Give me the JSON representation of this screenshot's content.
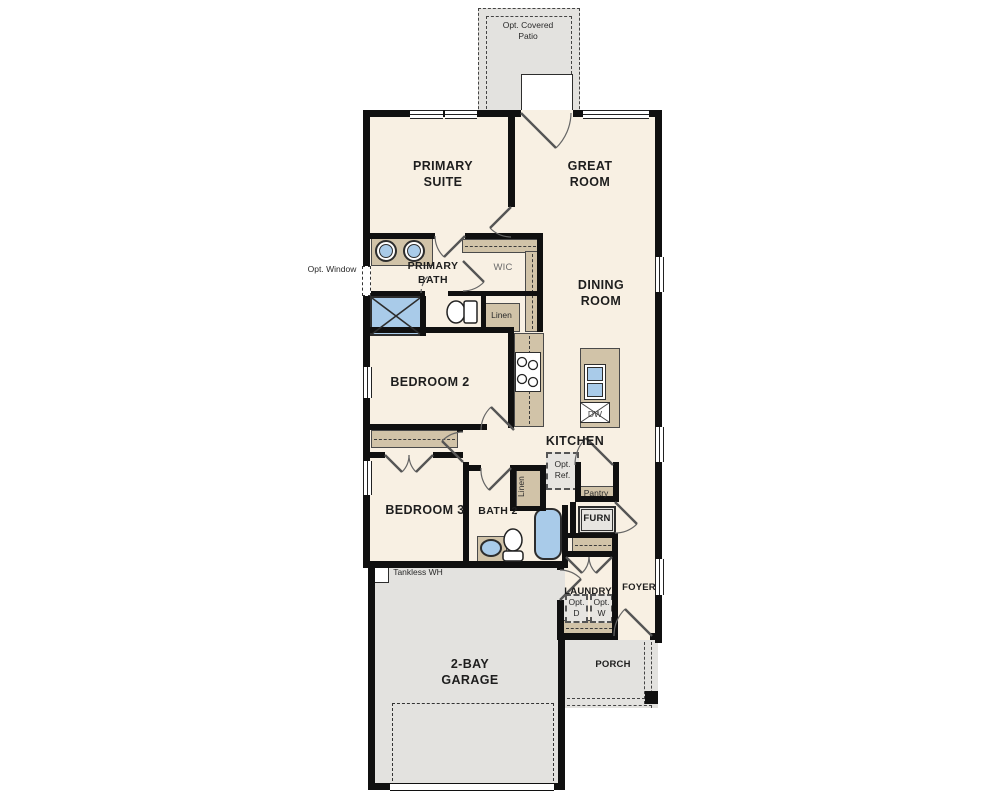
{
  "colors": {
    "floor": "#f8f0e3",
    "exterior": "#e3e2df",
    "cabinet": "#d1c3a8",
    "fixture_blue": "#a9cbe9",
    "wall": "#101010"
  },
  "rooms": {
    "patio": {
      "label": "Opt. Covered Patio"
    },
    "primary_suite": {
      "label": "PRIMARY SUITE"
    },
    "great_room": {
      "label": "GREAT ROOM"
    },
    "primary_bath": {
      "label": "PRIMARY BATH"
    },
    "wic": {
      "label": "WIC"
    },
    "dining_room": {
      "label": "DINING ROOM"
    },
    "bedroom2": {
      "label": "BEDROOM 2"
    },
    "kitchen": {
      "label": "KITCHEN"
    },
    "bedroom3": {
      "label": "BEDROOM 3"
    },
    "bath2": {
      "label": "BATH 2"
    },
    "laundry": {
      "label": "LAUNDRY"
    },
    "foyer": {
      "label": "FOYER"
    },
    "garage": {
      "label": "2-BAY GARAGE"
    },
    "porch": {
      "label": "PORCH"
    }
  },
  "labels": {
    "opt_window": "Opt. Window",
    "linen_hall": "Linen",
    "linen_bath2": "Linen",
    "opt_ref": "Opt. Ref.",
    "pantry": "Pantry",
    "furnace": "FURN",
    "dishwasher": "DW",
    "tankless_wh": "Tankless WH",
    "opt_dryer": "Opt. D",
    "opt_washer": "Opt. W"
  }
}
